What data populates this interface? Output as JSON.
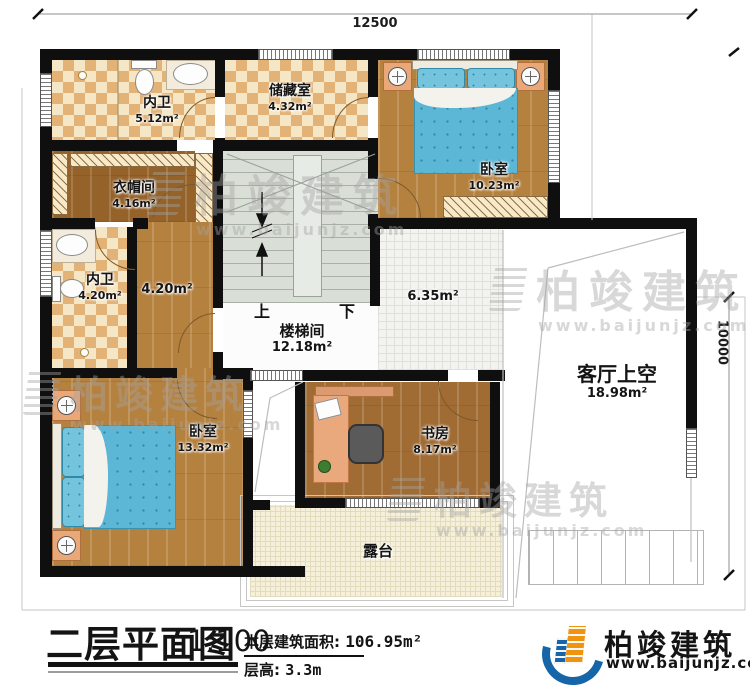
{
  "plan": {
    "dimensions": {
      "top": "12500",
      "right": "10000"
    },
    "rooms": {
      "bath_top": {
        "name": "内卫",
        "area": "5.12m²"
      },
      "storage": {
        "name": "储藏室",
        "area": "4.32m²"
      },
      "bedroom_top": {
        "name": "卧室",
        "area": "10.23m²"
      },
      "cloakroom": {
        "name": "衣帽间",
        "area": "4.16m²"
      },
      "bath_mid": {
        "name": "内卫",
        "area": "4.20m²"
      },
      "corridor": {
        "area": "4.20m²"
      },
      "stairwell": {
        "name": "楼梯间",
        "area": "12.18m²",
        "up": "上",
        "down": "下"
      },
      "hall": {
        "area": "6.35m²"
      },
      "living_void": {
        "name": "客厅上空",
        "area": "18.98m²"
      },
      "bedroom_bottom": {
        "name": "卧室",
        "area": "13.32m²"
      },
      "study": {
        "name": "书房",
        "area": "8.17m²"
      },
      "terrace": {
        "name": "露台"
      }
    }
  },
  "watermark": {
    "brand": "柏竣建筑",
    "url": "www.baijunjz.com"
  },
  "title_block": {
    "title": "二层平面图",
    "scale": "1:100",
    "area_label": "本层建筑面积:",
    "area_value": "106.95m²",
    "floor_height_label": "层高:",
    "floor_height_value": "3.3m"
  },
  "logo": {
    "brand": "柏竣建筑",
    "url": "www.baijunjz.com"
  },
  "colors": {
    "wall": "#0f0f0f",
    "bed": "#5cb7d6",
    "logo_blue": "#1565a8",
    "logo_orange": "#f0940f"
  }
}
